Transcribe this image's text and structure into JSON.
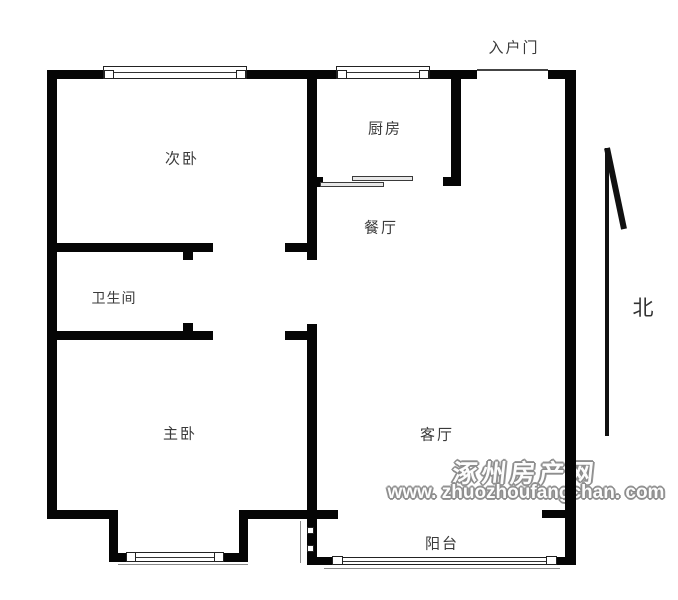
{
  "rooms": {
    "secondary_bedroom": "次卧",
    "kitchen": "厨房",
    "dining": "餐厅",
    "bathroom": "卫生间",
    "master_bedroom": "主卧",
    "living": "客厅",
    "balcony": "阳台"
  },
  "entrance_label": "入户门",
  "compass": {
    "north_label": "北"
  },
  "watermark": {
    "site_name": "涿州房产网",
    "site_url": "www. zhuozhoufangchan. com"
  },
  "colors": {
    "wall": "#050505",
    "label_text": "#3a3a3a",
    "watermark_gray": "#8c8c8c",
    "background": "#ffffff"
  }
}
